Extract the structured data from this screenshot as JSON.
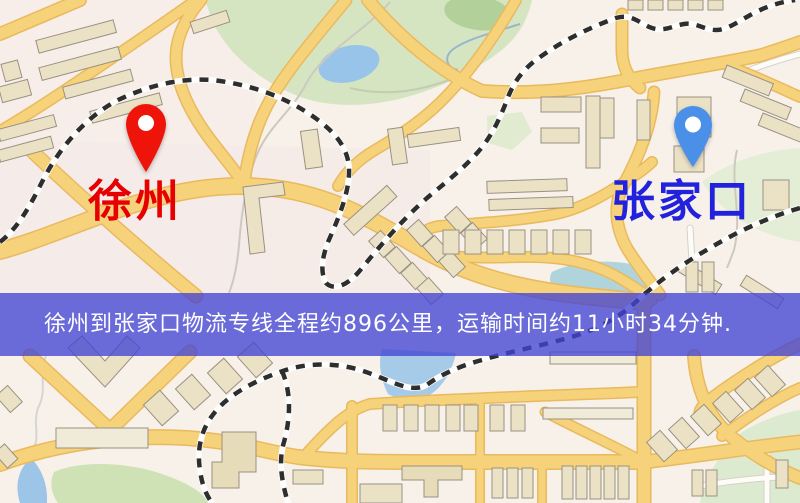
{
  "map": {
    "origin": {
      "name": "徐州",
      "pin_color": "#ee1409",
      "label_color": "#e60000"
    },
    "destination": {
      "name": "张家口",
      "pin_color": "#4a90e8",
      "label_color": "#2222dd"
    }
  },
  "banner": {
    "text": "徐州到张家口物流专线全程约896公里，运输时间约11小时34分钟.",
    "distance_km": "896",
    "duration": "11小时34分钟",
    "background_color": "#4244d4",
    "text_color": "#ffffff"
  },
  "map_style": {
    "base_color": "#f7f1ea",
    "road_color": "#f6d37a",
    "road_casing_color": "#eab95e",
    "park_color": "#d6e5c1",
    "water_color": "#98c4e9",
    "building_color": "#ebe2c6",
    "railway_color": "#2e2e2e"
  }
}
